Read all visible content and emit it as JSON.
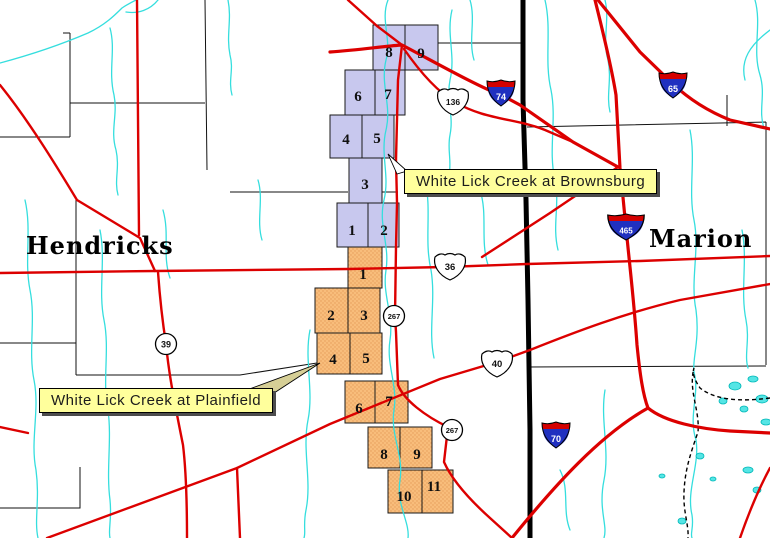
{
  "counties": {
    "west": "Hendricks",
    "east": "Marion"
  },
  "callouts": {
    "brownsburg": "White Lick Creek at Brownsburg",
    "plainfield": "White Lick Creek at Plainfield"
  },
  "watersheds": {
    "brownsburg": {
      "label": "White Lick Creek at Brownsburg",
      "color": "#c8c8ee",
      "cells": [
        {
          "n": "1"
        },
        {
          "n": "2"
        },
        {
          "n": "3"
        },
        {
          "n": "4"
        },
        {
          "n": "5"
        },
        {
          "n": "6"
        },
        {
          "n": "7"
        },
        {
          "n": "8"
        },
        {
          "n": "9"
        }
      ]
    },
    "plainfield": {
      "label": "White Lick Creek at Plainfield",
      "color": "#f8bd7b",
      "cells": [
        {
          "n": "1"
        },
        {
          "n": "2"
        },
        {
          "n": "3"
        },
        {
          "n": "4"
        },
        {
          "n": "5"
        },
        {
          "n": "6"
        },
        {
          "n": "7"
        },
        {
          "n": "8"
        },
        {
          "n": "9"
        },
        {
          "n": "10"
        },
        {
          "n": "11"
        }
      ]
    }
  },
  "shields": {
    "interstates": [
      {
        "num": "74"
      },
      {
        "num": "65"
      },
      {
        "num": "465"
      },
      {
        "num": "70"
      }
    ],
    "us_routes": [
      {
        "num": "136"
      },
      {
        "num": "36"
      },
      {
        "num": "40"
      }
    ],
    "state_routes": [
      {
        "num": "39"
      },
      {
        "num": "267"
      },
      {
        "num": "267"
      }
    ]
  },
  "colors": {
    "road": "#dc0000",
    "stream": "#35dede",
    "county_boundary": "#000000",
    "brownsburg_fill": "#c8c8ee",
    "plainfield_fill": "#f8bd7b",
    "callout_bg": "#ffff9c",
    "interstate_blue": "#2030c0",
    "interstate_red": "#d40000"
  }
}
